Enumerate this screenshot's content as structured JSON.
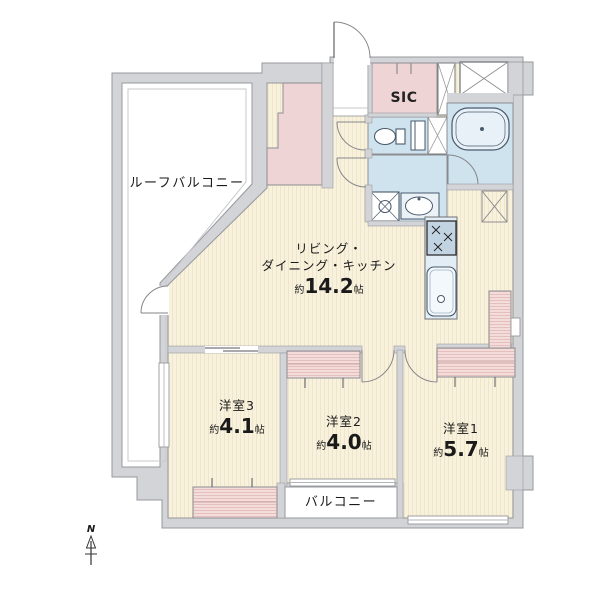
{
  "plan_type": "floor-plan",
  "rooms": {
    "roof_balcony": {
      "label": "ルーフバルコニー"
    },
    "balcony": {
      "label": "バルコニー"
    },
    "sic": {
      "label": "SIC"
    },
    "ldk": {
      "line1": "リビング・",
      "line2": "ダイニング・キッチン",
      "approx": "約",
      "area": "14.2",
      "unit": "帖"
    },
    "bedroom1": {
      "name": "洋室1",
      "approx": "約",
      "area": "5.7",
      "unit": "帖"
    },
    "bedroom2": {
      "name": "洋室2",
      "approx": "約",
      "area": "4.0",
      "unit": "帖"
    },
    "bedroom3": {
      "name": "洋室3",
      "approx": "約",
      "area": "4.1",
      "unit": "帖"
    }
  },
  "compass": {
    "north": "N"
  },
  "colors": {
    "wall": "#d3d4d7",
    "floor": "#f8f1dd",
    "wet_area": "#cfe3ef",
    "closet": "#f3dcda",
    "storage_pink": "#eed4d4",
    "outline": "#97989c",
    "fixture_line": "#4a5a6c"
  }
}
